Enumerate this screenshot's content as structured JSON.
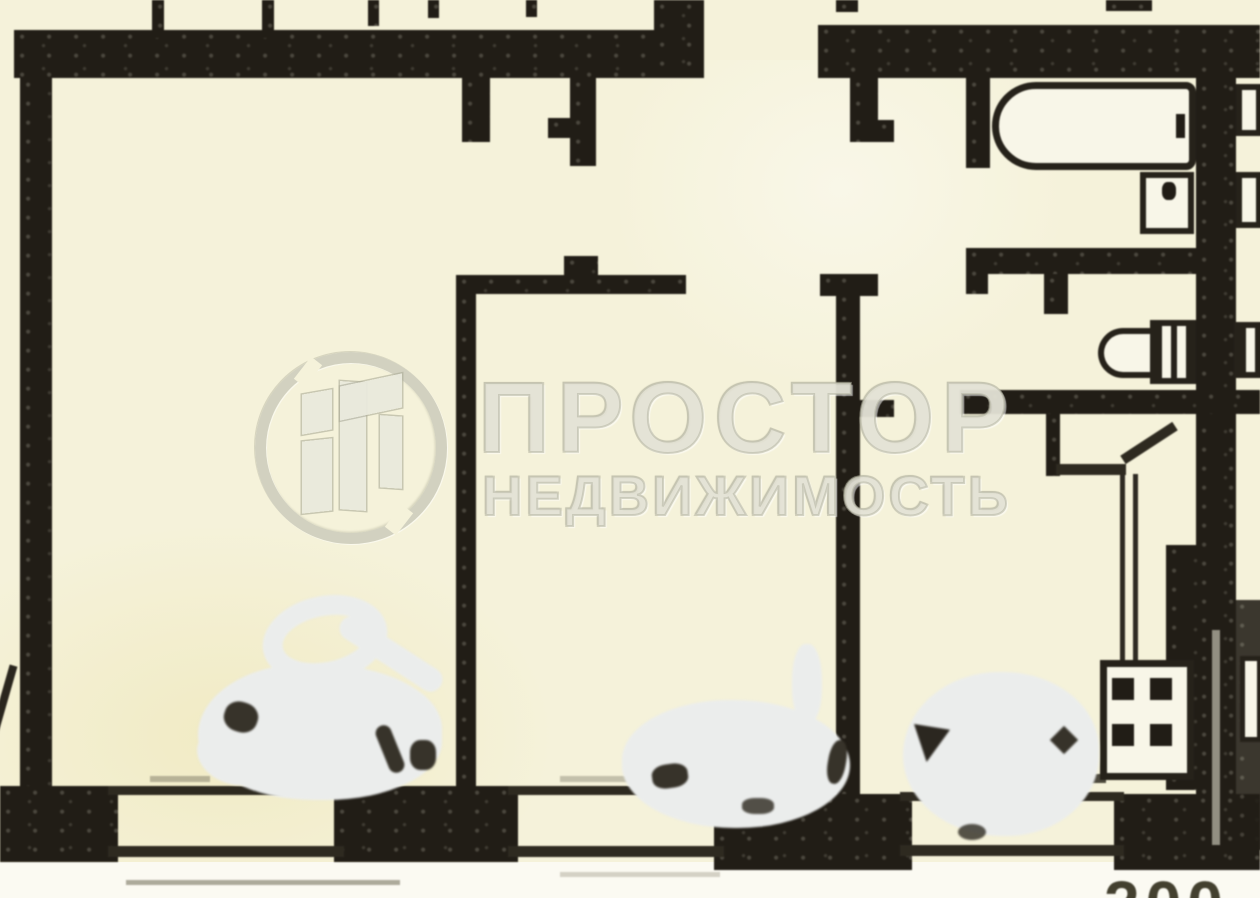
{
  "document": {
    "kind": "scanned apartment floor plan",
    "language": "ru"
  },
  "watermark": {
    "logo": "prostor-circle-building-logo",
    "title": "ПРОСТОР",
    "subtitle": "НЕДВИЖИМОСТЬ"
  },
  "corner_stamp": {
    "visible_digits": "200"
  },
  "plan": {
    "fixtures": [
      "bathtub-icon",
      "washbasin-icon",
      "toilet-icon",
      "stove-icon",
      "kitchen-counter-icon",
      "radiator-dashes-icon"
    ],
    "windows_count": 3,
    "eraser_blobs_count": 3,
    "balcony_ticks_count": 5
  },
  "palette": {
    "paper": "#f5f2da",
    "ink": "#211d16",
    "watermark_fill": "#e2e1cf",
    "watermark_stroke": "#b2b29a",
    "eraser_blob": "#ebedec",
    "stamp_digits": "#43402f"
  }
}
